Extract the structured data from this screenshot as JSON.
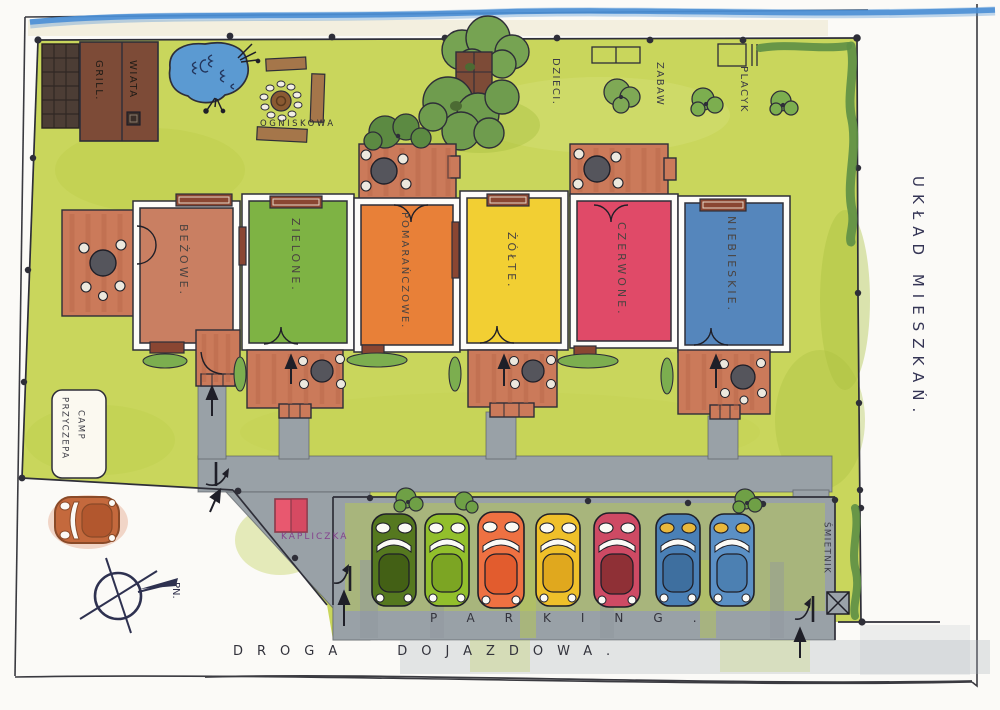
{
  "map": {
    "title": "UKŁAD MIESZKAŃ.",
    "labels": {
      "grill": "GRILL.",
      "wiata": "WIATA",
      "ogniskowa": "OGNISKOWA",
      "playground": [
        "PLACYK",
        "ZABAW",
        "DZIECI."
      ],
      "camp_line1": "PRZYCZEPA",
      "camp_line2": "CAMP",
      "kapliczka": "KAPLICZKA",
      "smietnik": "ŚMIETNIK",
      "parking": "PARKING.",
      "road_word1": "DROGA",
      "road_word2": "DOJAZDOWA.",
      "compass_north": "PN."
    },
    "houses": [
      {
        "label": "BEŻOWE.",
        "color": "#c97f62"
      },
      {
        "label": "ZIELONE.",
        "color": "#7eb344"
      },
      {
        "label": "POMARAŃCZOWE.",
        "color": "#e88038"
      },
      {
        "label": "ŻÓŁTE.",
        "color": "#f2cf33"
      },
      {
        "label": "CZERWONE.",
        "color": "#e04a68"
      },
      {
        "label": "NIEBIESKIE.",
        "color": "#5586bc"
      }
    ],
    "cars": [
      {
        "name": "dark-green-car",
        "body": "#55781f",
        "roof": "#436015",
        "window": "#fbfaf4"
      },
      {
        "name": "light-green-car",
        "body": "#92bf2c",
        "roof": "#7ca523",
        "window": "#fbfaf4"
      },
      {
        "name": "orange-car",
        "body": "#ee7142",
        "roof": "#e25c2e",
        "window": "#fbfaf4"
      },
      {
        "name": "yellow-car",
        "body": "#efc02a",
        "roof": "#e0a81e",
        "window": "#fbfaf4"
      },
      {
        "name": "red-car",
        "body": "#ce4a64",
        "roof": "#8f3036",
        "window": "#fbfaf4"
      },
      {
        "name": "blue-car-1",
        "body": "#4a80b6",
        "roof": "#3e6f9f",
        "window": "#e9b83c"
      },
      {
        "name": "blue-car-2",
        "body": "#5b90c5",
        "roof": "#4c80b2",
        "window": "#e9b83c"
      }
    ],
    "street_car": {
      "name": "orange-parked-car",
      "body": "#c4693d",
      "roof": "#b2572e"
    },
    "colors": {
      "grass": "#c9d65c",
      "path_gray": "#99a1a7",
      "patio": "#cb7a5a",
      "ink": "#2e2e38",
      "stream_blue": "#4b8fd5",
      "building_brown": "#7d4b37",
      "hedge_green": "#5d8f45",
      "pond_blue": "#5b9ad2",
      "kapliczka_pink": "#e8586f"
    }
  }
}
